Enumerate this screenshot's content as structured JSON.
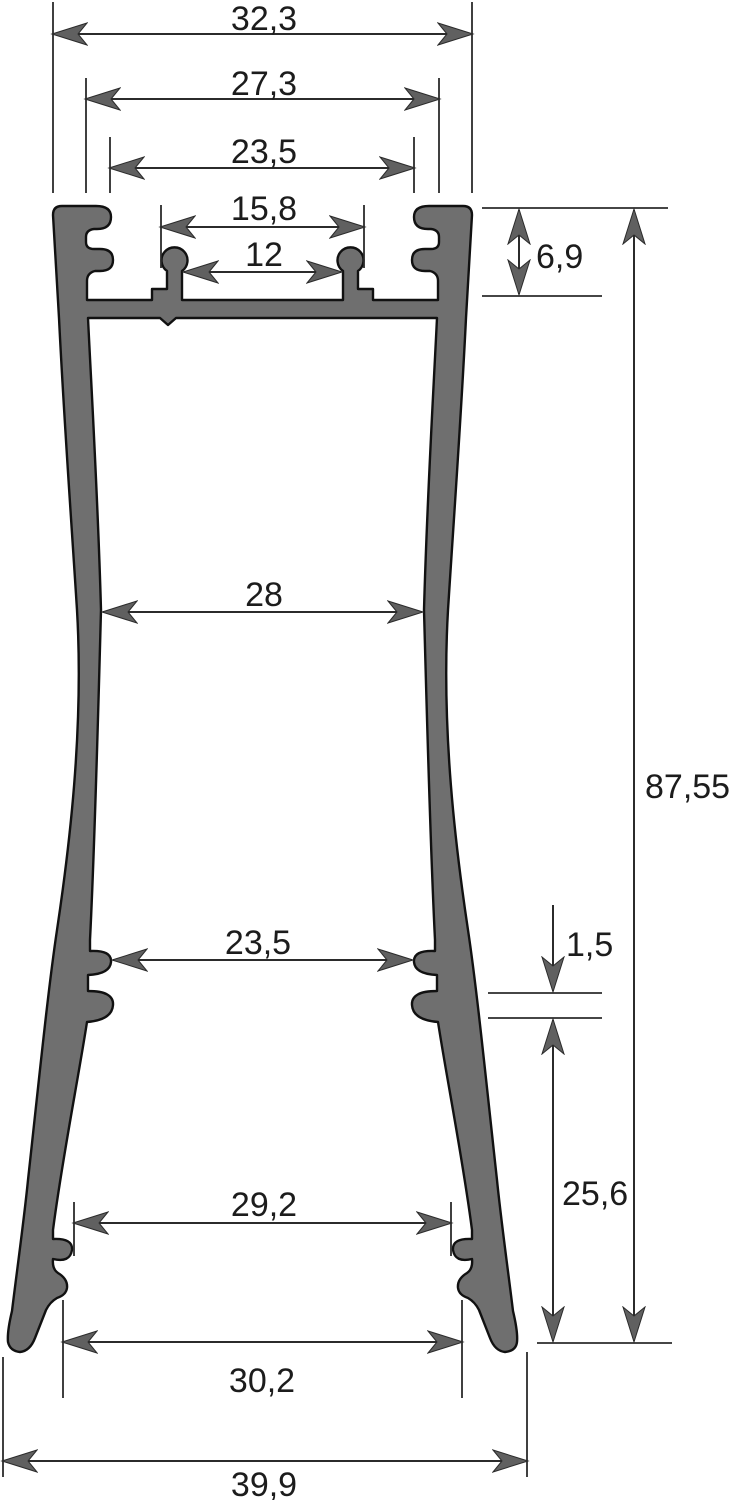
{
  "drawing": {
    "type": "technical-cross-section",
    "subject": "aluminum LED profile cross-section with dimension callouts",
    "units_style": "comma-decimal",
    "profile_fill_color": "#6f6f6f",
    "line_color": "#2b2b2b",
    "text_color": "#1c1c1c"
  },
  "dimensions": {
    "top_outer_width": "32,3",
    "flange_groove_width": "27,3",
    "top_opening_width": "23,5",
    "led_slot_outer_width": "15,8",
    "led_slot_inner_width": "12",
    "top_section_height": "6,9",
    "waist_inner_width": "28",
    "overall_height": "87,55",
    "lower_inner_width": "23,5",
    "rib_thickness": "1,5",
    "lower_section_height": "25,6",
    "foot_inner_width": "29,2",
    "foot_notch_width": "30,2",
    "overall_base_width": "39,9"
  }
}
